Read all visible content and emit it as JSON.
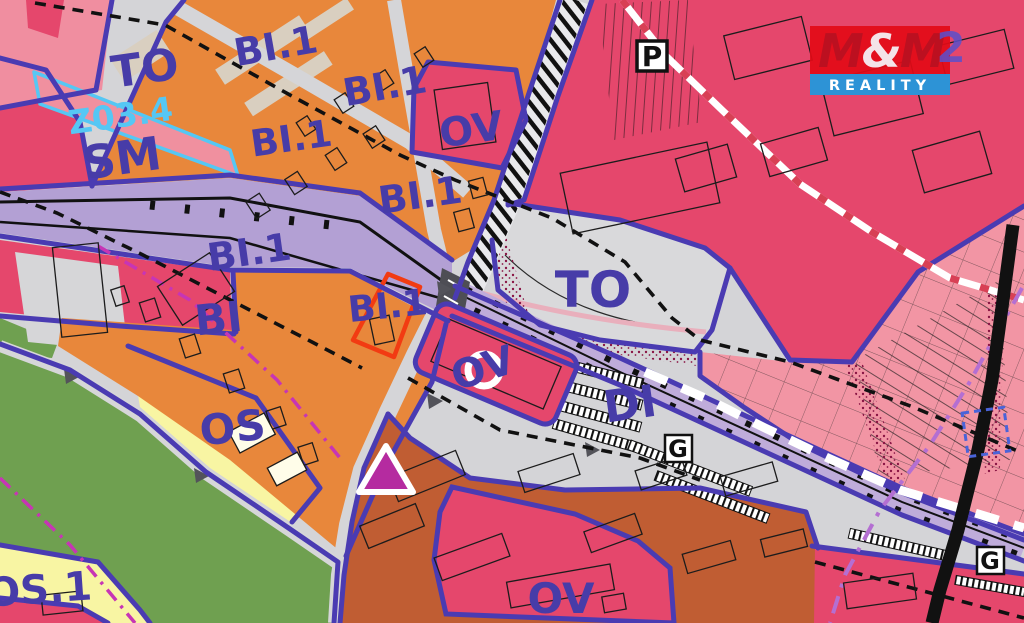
{
  "map": {
    "labels": [
      {
        "id": "to-upper",
        "text": "TO"
      },
      {
        "id": "bi1-a",
        "text": "BI.1"
      },
      {
        "id": "bi1-b",
        "text": "BI.1"
      },
      {
        "id": "ov-upper",
        "text": "OV"
      },
      {
        "id": "bi1-c",
        "text": "BI.1"
      },
      {
        "id": "z034",
        "text": "Z03.4"
      },
      {
        "id": "sm",
        "text": "SM"
      },
      {
        "id": "bi1-d",
        "text": "BI.1"
      },
      {
        "id": "bi1-e",
        "text": "BI.1"
      },
      {
        "id": "bi",
        "text": "BI"
      },
      {
        "id": "bi1-f",
        "text": "BI.1"
      },
      {
        "id": "to-central",
        "text": "TO"
      },
      {
        "id": "ov-central",
        "text": "OV"
      },
      {
        "id": "di",
        "text": "DI"
      },
      {
        "id": "os",
        "text": "OS"
      },
      {
        "id": "os1",
        "text": "OS.1"
      },
      {
        "id": "ov-lower",
        "text": "OV"
      },
      {
        "id": "logo-overlap",
        "text": "2"
      }
    ],
    "symbols": [
      {
        "id": "parking",
        "glyph": "P"
      },
      {
        "id": "garage-1",
        "glyph": "G"
      },
      {
        "id": "garage-2",
        "glyph": "G"
      }
    ],
    "logo": {
      "m1": "M",
      "amp": "&",
      "m2": "M",
      "reality": "REALITY"
    },
    "colors": {
      "label_blue": "#473CA8",
      "border_blue": "#4A3BB2",
      "orange": "#E8873B",
      "crimson": "#E5476C",
      "light_pink": "#F295A4",
      "lavender": "#BFACDA",
      "gray": "#D4D4D7",
      "green": "#6FA050",
      "yellow": "#F8F5A3",
      "brown": "#C05D33",
      "highlight_red": "#F23B12",
      "magenta": "#C735B5",
      "violet_dash": "#B46FD2",
      "cyan": "#55C7F4",
      "logo_red": "#E30B17",
      "logo_blue": "#2D93D6",
      "marker_magenta": "#B52BA0"
    }
  }
}
